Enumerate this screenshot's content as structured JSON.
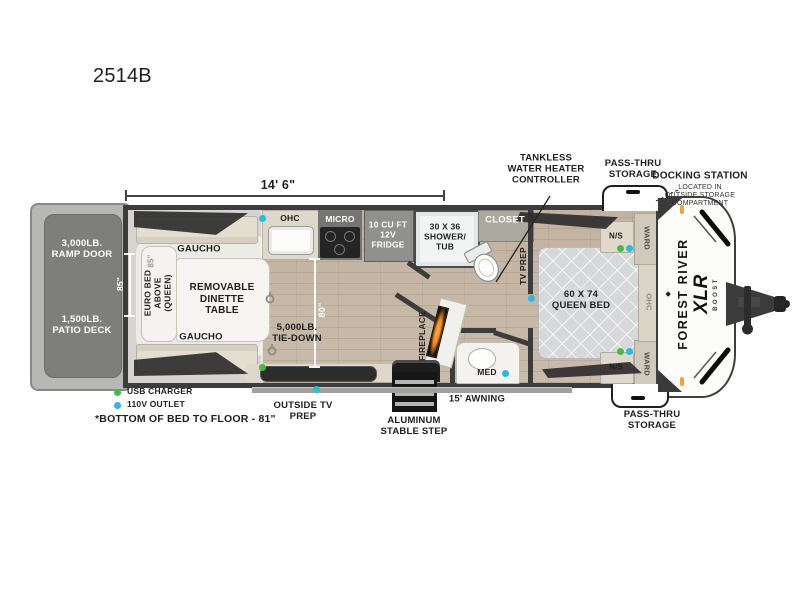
{
  "model": "2514B",
  "dimensions": {
    "length": "14' 6\"",
    "width_left": "85\"",
    "bed_width": "85\"",
    "garage_length": "80\""
  },
  "patio": {
    "ramp": "3,000LB.\nRAMP DOOR",
    "deck": "1,500LB.\nPATIO DECK"
  },
  "garage": {
    "gaucho_top": "GAUCHO",
    "gaucho_bottom": "GAUCHO",
    "euro_bed": "EURO BED\nABOVE\n(QUEEN)",
    "dinette": "REMOVABLE\nDINETTE\nTABLE",
    "tie_down": "5,000LB.\nTIE-DOWN"
  },
  "kitchen": {
    "ohc": "OHC",
    "micro": "MICRO",
    "fridge": "10 CU FT\n12V\nFRIDGE"
  },
  "bath": {
    "shower": "30 X 36\nSHOWER/\nTUB",
    "closet": "CLOSET",
    "med": "MED"
  },
  "living": {
    "fireplace": "FIREPLACE",
    "tv_prep": "TV PREP"
  },
  "bedroom": {
    "bed": "60 X 74\nQUEEN BED",
    "ns_top": "N/S",
    "ns_bottom": "N/S",
    "ward_top": "WARD",
    "ward_bottom": "WARD",
    "ohc": "OHC"
  },
  "exterior": {
    "tankless": "TANKLESS\nWATER HEATER\nCONTROLLER",
    "pass_thru_top": "PASS-THRU\nSTORAGE",
    "pass_thru_bottom": "PASS-THRU\nSTORAGE",
    "docking": "DOCKING STATION",
    "docking_note": "LOCATED IN\nOUTSIDE STORAGE\nCOMPARTMENT",
    "awning": "15' AWNING",
    "step": "ALUMINUM\nSTABLE STEP",
    "outside_tv": "OUTSIDE TV\nPREP"
  },
  "brand": {
    "emblem": "◆",
    "name": "FOREST RIVER",
    "model_line": "XLR",
    "sub": "BOOST"
  },
  "legend": {
    "usb": "USB CHARGER",
    "outlet": "110V OUTLET",
    "note": "*BOTTOM OF BED TO FLOOR - 81\""
  },
  "colors": {
    "usb_dot": "#3fbe3f",
    "outlet_dot": "#2cb9e8",
    "flame": "#ff8c1a",
    "marker_light": "#f0a23c",
    "wall": "#3c3c3c"
  }
}
